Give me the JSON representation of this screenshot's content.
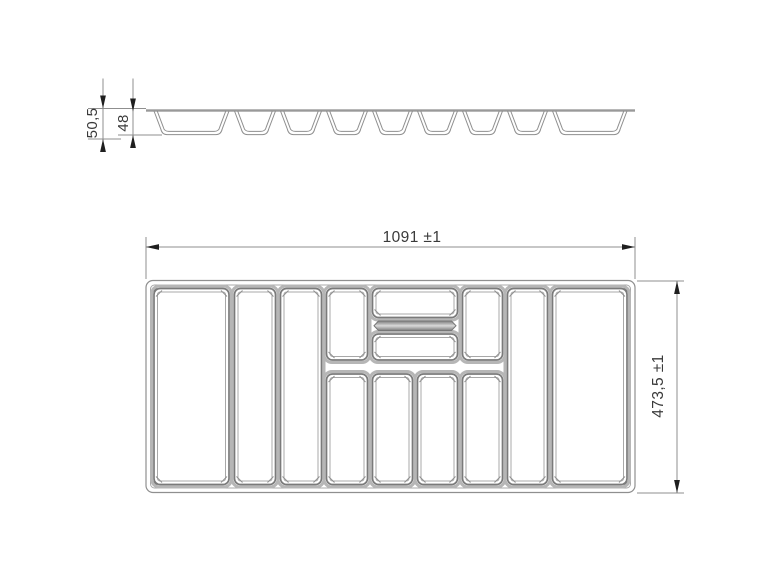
{
  "drawing_title": "cutlery-tray-technical-drawing",
  "labels": {
    "dim_width": "1091 ±1",
    "dim_height": "473,5 ±1",
    "dim_section_height": "50,5",
    "dim_section_depth": "48"
  },
  "colors": {
    "background": "#ffffff",
    "line": "#8f8f8f",
    "dark_line": "#7a7a7a",
    "light_line": "#a8a8a8",
    "halo": "#b6b6b6",
    "arrow": "#1f1f1f",
    "text": "#3a3a3a",
    "top_line": "#999999",
    "bar_edge": "#777777",
    "bar_mid": "#d9d9d9"
  },
  "section_view": {
    "top_line": {
      "x1": 146,
      "x2": 635,
      "y": 109.3,
      "thickness": 2.4
    },
    "trough_top_y": 111,
    "trough_bottom_y": 134.6,
    "trough_inner_bottom_y": 131.4,
    "troughs": [
      {
        "x1": 154,
        "x2": 229
      },
      {
        "x1": 234.5,
        "x2": 275.5
      },
      {
        "x1": 280.5,
        "x2": 321.5
      },
      {
        "x1": 326.5,
        "x2": 367.5
      },
      {
        "x1": 372.5,
        "x2": 412.5
      },
      {
        "x1": 417.5,
        "x2": 457.5
      },
      {
        "x1": 462.5,
        "x2": 502.5
      },
      {
        "x1": 507.5,
        "x2": 547.5
      },
      {
        "x1": 552.5,
        "x2": 627
      }
    ]
  },
  "plan_view": {
    "outer_rect": {
      "x": 146,
      "y": 280.5,
      "w": 489,
      "h": 212
    },
    "inner_rect": {
      "x": 150.5,
      "y": 285,
      "w": 480,
      "h": 203
    },
    "compartments": [
      {
        "name": "left-large",
        "x": 154,
        "y": 288.5,
        "w": 75,
        "h": 196
      },
      {
        "name": "col-2",
        "x": 234.5,
        "y": 288.5,
        "w": 41,
        "h": 196
      },
      {
        "name": "col-3",
        "x": 280.5,
        "y": 288.5,
        "w": 41,
        "h": 196
      },
      {
        "name": "col-4-top",
        "x": 326.5,
        "y": 288.5,
        "w": 41,
        "h": 71.5
      },
      {
        "name": "col-4-bottom",
        "x": 326.5,
        "y": 374,
        "w": 41,
        "h": 110.5
      },
      {
        "name": "center-top",
        "x": 372.5,
        "y": 288.5,
        "w": 85,
        "h": 29
      },
      {
        "name": "center-middle",
        "x": 372.5,
        "y": 334,
        "w": 85,
        "h": 26
      },
      {
        "name": "col-5-bottom",
        "x": 372.5,
        "y": 374,
        "w": 40,
        "h": 110.5
      },
      {
        "name": "col-6-bottom",
        "x": 417.5,
        "y": 374,
        "w": 40,
        "h": 110.5
      },
      {
        "name": "col-7-top",
        "x": 462.5,
        "y": 288.5,
        "w": 40,
        "h": 71.5
      },
      {
        "name": "col-7-bottom",
        "x": 462.5,
        "y": 374,
        "w": 40,
        "h": 110.5
      },
      {
        "name": "col-8",
        "x": 507.5,
        "y": 288.5,
        "w": 40,
        "h": 196
      },
      {
        "name": "right-large",
        "x": 552.5,
        "y": 288.5,
        "w": 74.5,
        "h": 196
      }
    ],
    "divider_bar": {
      "x": 374,
      "y": 321,
      "w": 82,
      "h": 9.5
    }
  },
  "dimensions": [
    {
      "id": "width",
      "orient": "h",
      "pos": 247,
      "from": 146,
      "to": 635,
      "arrows": "inside",
      "ext": [
        {
          "x": 146,
          "y1": 237,
          "y2": 279
        },
        {
          "x": 635,
          "y1": 237,
          "y2": 279
        }
      ]
    },
    {
      "id": "height",
      "orient": "v",
      "pos": 677,
      "from": 281,
      "to": 493,
      "arrows": "inside",
      "ext": [
        {
          "y": 281,
          "x1": 637,
          "x2": 684
        },
        {
          "y": 493,
          "x1": 637,
          "x2": 684
        }
      ]
    },
    {
      "id": "sec-height",
      "orient": "v",
      "pos": 103,
      "from": 108.5,
      "to": 139,
      "arrows": "outside",
      "over1": 30,
      "over2": 13,
      "ext": [
        {
          "y": 108.5,
          "x1": 88,
          "x2": 146
        },
        {
          "y": 139,
          "x1": 88,
          "x2": 121
        }
      ]
    },
    {
      "id": "sec-depth",
      "orient": "v",
      "pos": 133,
      "from": 111.5,
      "to": 135,
      "arrows": "outside",
      "over1": 33,
      "over2": 13,
      "ext": [
        {
          "y": 135,
          "x1": 118,
          "x2": 162
        }
      ]
    }
  ]
}
